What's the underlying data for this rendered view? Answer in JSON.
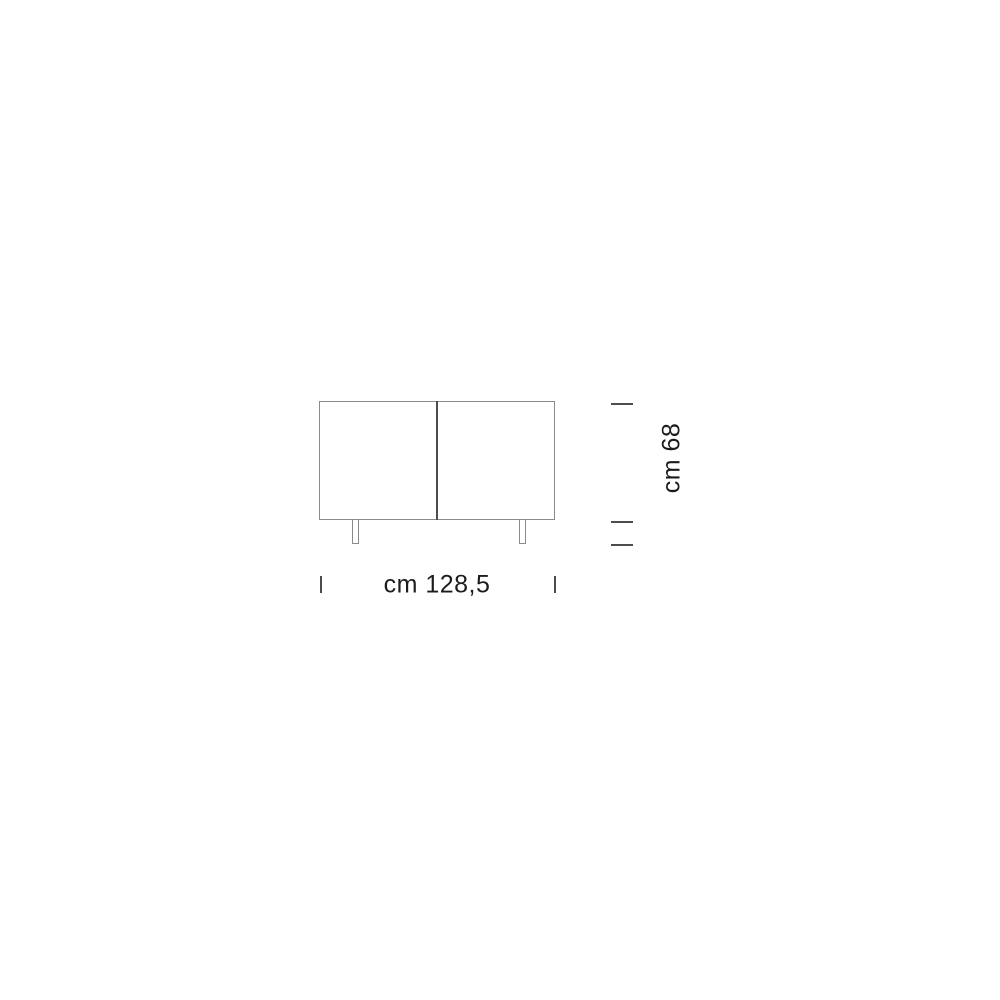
{
  "diagram": {
    "type": "product-dimension-drawing",
    "subject": "two-door sideboard, front elevation",
    "width_label": "cm 128,5",
    "height_label": "cm 68",
    "dimensions": {
      "width_cm": "128,5",
      "height_cm": "68"
    },
    "colors": {
      "outline": "#8a8a8a",
      "divider": "#4d4d4d",
      "tick": "#4d4d4d",
      "ink": "#1c1c1c",
      "bg": "#ffffff"
    }
  }
}
